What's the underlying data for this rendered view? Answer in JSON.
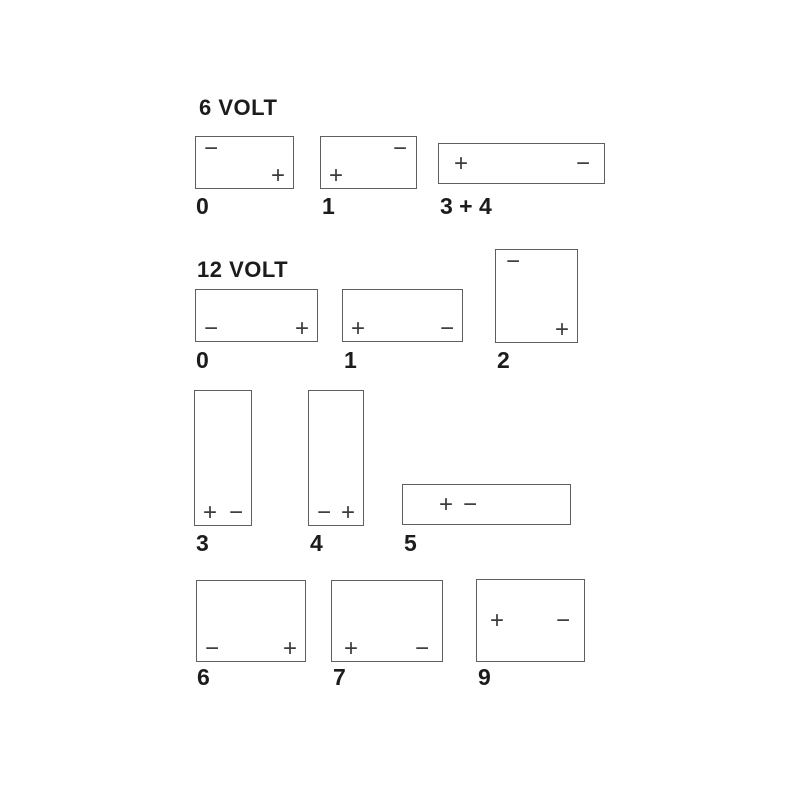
{
  "colors": {
    "background": "#ffffff",
    "box_border": "#5f5f5f",
    "terminal": "#3c3c3c",
    "text": "#1c1c1c"
  },
  "sections": [
    {
      "title": "6 VOLT",
      "batteries": [
        {
          "label": "0",
          "terminals": [
            {
              "name": "negative",
              "sign": "−",
              "pos": "top-left"
            },
            {
              "name": "positive",
              "sign": "+",
              "pos": "bottom-right"
            }
          ]
        },
        {
          "label": "1",
          "terminals": [
            {
              "name": "positive",
              "sign": "+",
              "pos": "bottom-left"
            },
            {
              "name": "negative",
              "sign": "−",
              "pos": "top-right"
            }
          ]
        },
        {
          "label": "3 + 4",
          "terminals": [
            {
              "name": "positive",
              "sign": "+",
              "pos": "middle-left"
            },
            {
              "name": "negative",
              "sign": "−",
              "pos": "middle-right"
            }
          ]
        }
      ]
    },
    {
      "title": "12 VOLT",
      "batteries": [
        {
          "label": "0",
          "terminals": [
            {
              "name": "negative",
              "sign": "−",
              "pos": "bottom-left"
            },
            {
              "name": "positive",
              "sign": "+",
              "pos": "bottom-right"
            }
          ]
        },
        {
          "label": "1",
          "terminals": [
            {
              "name": "positive",
              "sign": "+",
              "pos": "bottom-left"
            },
            {
              "name": "negative",
              "sign": "−",
              "pos": "bottom-right"
            }
          ]
        },
        {
          "label": "2",
          "terminals": [
            {
              "name": "negative",
              "sign": "−",
              "pos": "top-left"
            },
            {
              "name": "positive",
              "sign": "+",
              "pos": "bottom-right"
            }
          ]
        },
        {
          "label": "3",
          "terminals": [
            {
              "name": "positive",
              "sign": "+",
              "pos": "bottom-left"
            },
            {
              "name": "negative",
              "sign": "−",
              "pos": "bottom-right"
            }
          ]
        },
        {
          "label": "4",
          "terminals": [
            {
              "name": "negative",
              "sign": "−",
              "pos": "bottom-left"
            },
            {
              "name": "positive",
              "sign": "+",
              "pos": "bottom-right"
            }
          ]
        },
        {
          "label": "5",
          "terminals": [
            {
              "name": "positive",
              "sign": "+",
              "pos": "center-left"
            },
            {
              "name": "negative",
              "sign": "−",
              "pos": "center-left-2"
            }
          ]
        },
        {
          "label": "6",
          "terminals": [
            {
              "name": "negative",
              "sign": "−",
              "pos": "bottom-left"
            },
            {
              "name": "positive",
              "sign": "+",
              "pos": "bottom-right"
            }
          ]
        },
        {
          "label": "7",
          "terminals": [
            {
              "name": "positive",
              "sign": "+",
              "pos": "bottom-left"
            },
            {
              "name": "negative",
              "sign": "−",
              "pos": "bottom-right"
            }
          ]
        },
        {
          "label": "9",
          "terminals": [
            {
              "name": "positive",
              "sign": "+",
              "pos": "middle-left"
            },
            {
              "name": "negative",
              "sign": "−",
              "pos": "middle-right"
            }
          ]
        }
      ]
    }
  ]
}
